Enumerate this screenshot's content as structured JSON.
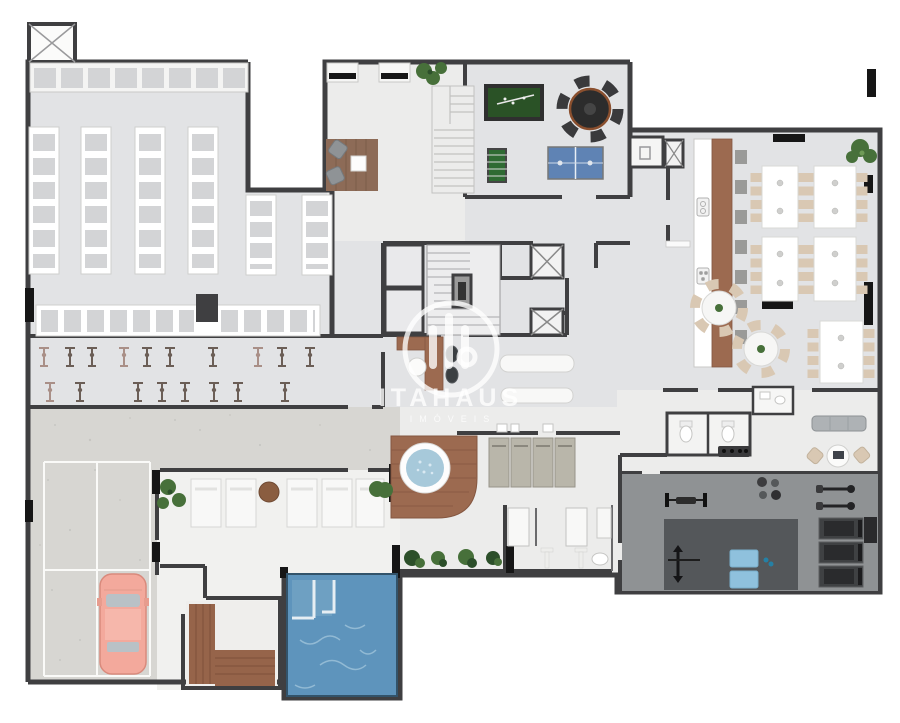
{
  "meta": {
    "type": "3D rendered architectural floor plan",
    "width_px": 900,
    "height_px": 723,
    "background": "#ffffff"
  },
  "watermark": {
    "brand": "ITAHAUS",
    "subtitle": "IMÓVEIS"
  },
  "palette": {
    "wall": "#3f3f41",
    "floor": "#e2e3e5",
    "floor_light": "#ececeb",
    "parking_floor": "#d7d6d2",
    "deck_floor": "#f1f1ef",
    "pool_water": "#5e94bc",
    "pool_highlight": "#9fc3da",
    "jacuzzi_water": "#a7c9da",
    "wood": "#9c6a50",
    "sauna_wood": "#96644a",
    "car_body": "#f3a99c",
    "plant_green": "#47703a",
    "plant_dark": "#2c4f2a",
    "billiard_green": "#2a5226",
    "pingpong_blue": "#5f83b4",
    "gym_floor": "#8f9294",
    "gym_mat": "#54575a",
    "equipment_dark": "#2e2f31",
    "chair_beige": "#d9c8b3",
    "locker_fill": "#d3d4d6",
    "lounger_gray": "#b9b6aa",
    "mat_blue": "#8fc1dd",
    "black_fixture": "#161616",
    "white_furniture": "#f8f8f7",
    "stool_gray": "#9a9a98",
    "watermark_white": "rgba(255,255,255,0.78)"
  },
  "areas": {
    "storage_lockers": {
      "locker_columns": 6,
      "top_row_black_doors": 2,
      "side_row_black_columns": 1
    },
    "lounge": {
      "armchairs": 2,
      "coffee_table": 1,
      "staircase": true,
      "wall_cabinets": 2
    },
    "games_room": {
      "billiard_table": 1,
      "round_table_seats": 6,
      "foosball_table": 1,
      "table_tennis_table": 1
    },
    "gourmet_restaurant": {
      "rect_tables": 5,
      "round_tables": 2,
      "bar_stools": 7,
      "kitchen_counter": true,
      "plants": 2
    },
    "core": {
      "elevators": 2,
      "stairwell": true,
      "x_shafts": 3
    },
    "fitness_row": {
      "machines_row1": 10,
      "machines_row2": 8
    },
    "spa": {
      "jacuzzi": 1,
      "gray_loungers": 4,
      "bar_stools": 2,
      "massage_tables": 2,
      "showers": 2,
      "planters": 4
    },
    "pool_deck": {
      "sun_loungers": 5,
      "side_table": 1,
      "plant_clusters": 2
    },
    "pool": {
      "entry_steps": 2
    },
    "sauna": {
      "benches": "L-shaped"
    },
    "parking": {
      "stalls": 6,
      "cars": 1
    },
    "gym": {
      "treadmills": 3,
      "spin_bikes": 2,
      "blue_mats": 2,
      "barbell_benches": 2,
      "weight_balls": 4
    },
    "restrooms": {
      "toilets": 4
    }
  }
}
